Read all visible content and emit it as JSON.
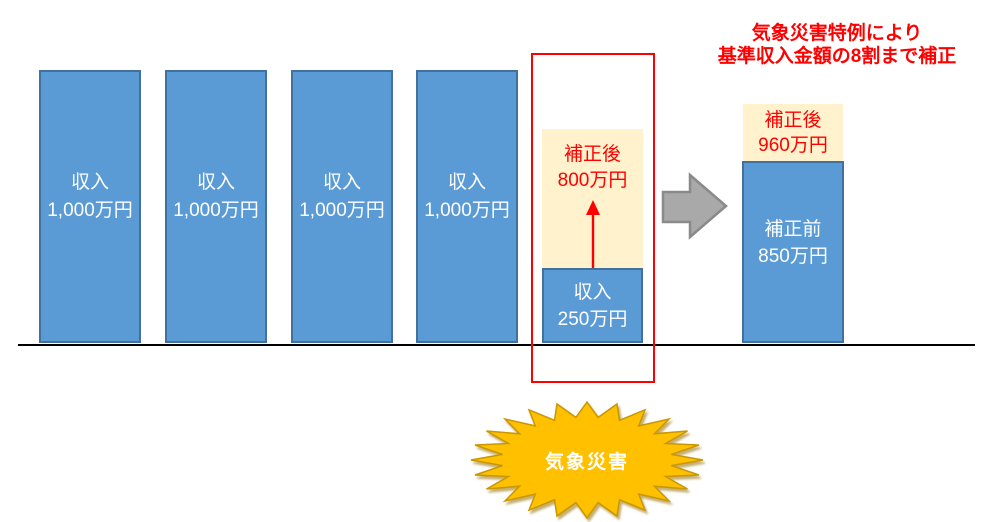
{
  "colors": {
    "bar_blue": "#5B9BD5",
    "bar_border": "#41719C",
    "cream": "#FFF2CC",
    "red": "#FF0000",
    "arrow_gray": "#A9A9A9",
    "starburst_gold": "#FFC000",
    "text_white": "#FFFFFF",
    "baseline_black": "#000000"
  },
  "normal_years": [
    {
      "line1": "収入",
      "line2": "1,000万円"
    },
    {
      "line1": "収入",
      "line2": "1,000万円"
    },
    {
      "line1": "収入",
      "line2": "1,000万円"
    },
    {
      "line1": "収入",
      "line2": "1,000万円"
    }
  ],
  "disaster_column": {
    "corrected": {
      "line1": "補正後",
      "line2": "800万円"
    },
    "income": {
      "line1": "収入",
      "line2": "250万円"
    }
  },
  "result_column": {
    "after": {
      "line1": "補正後",
      "line2": "960万円"
    },
    "before": {
      "line1": "補正前",
      "line2": "850万円"
    }
  },
  "annotation": {
    "line1": "気象災害特例により",
    "line2": "基準収入金額の8割まで補正"
  },
  "starburst": {
    "label": "気象災害"
  },
  "chart_data": {
    "type": "bar",
    "unit": "万円",
    "series": [
      {
        "name": "収入",
        "values": [
          1000,
          1000,
          1000,
          1000,
          250
        ]
      }
    ],
    "disaster_year_corrected_value": 800,
    "result": {
      "before": 850,
      "after": 960
    }
  }
}
